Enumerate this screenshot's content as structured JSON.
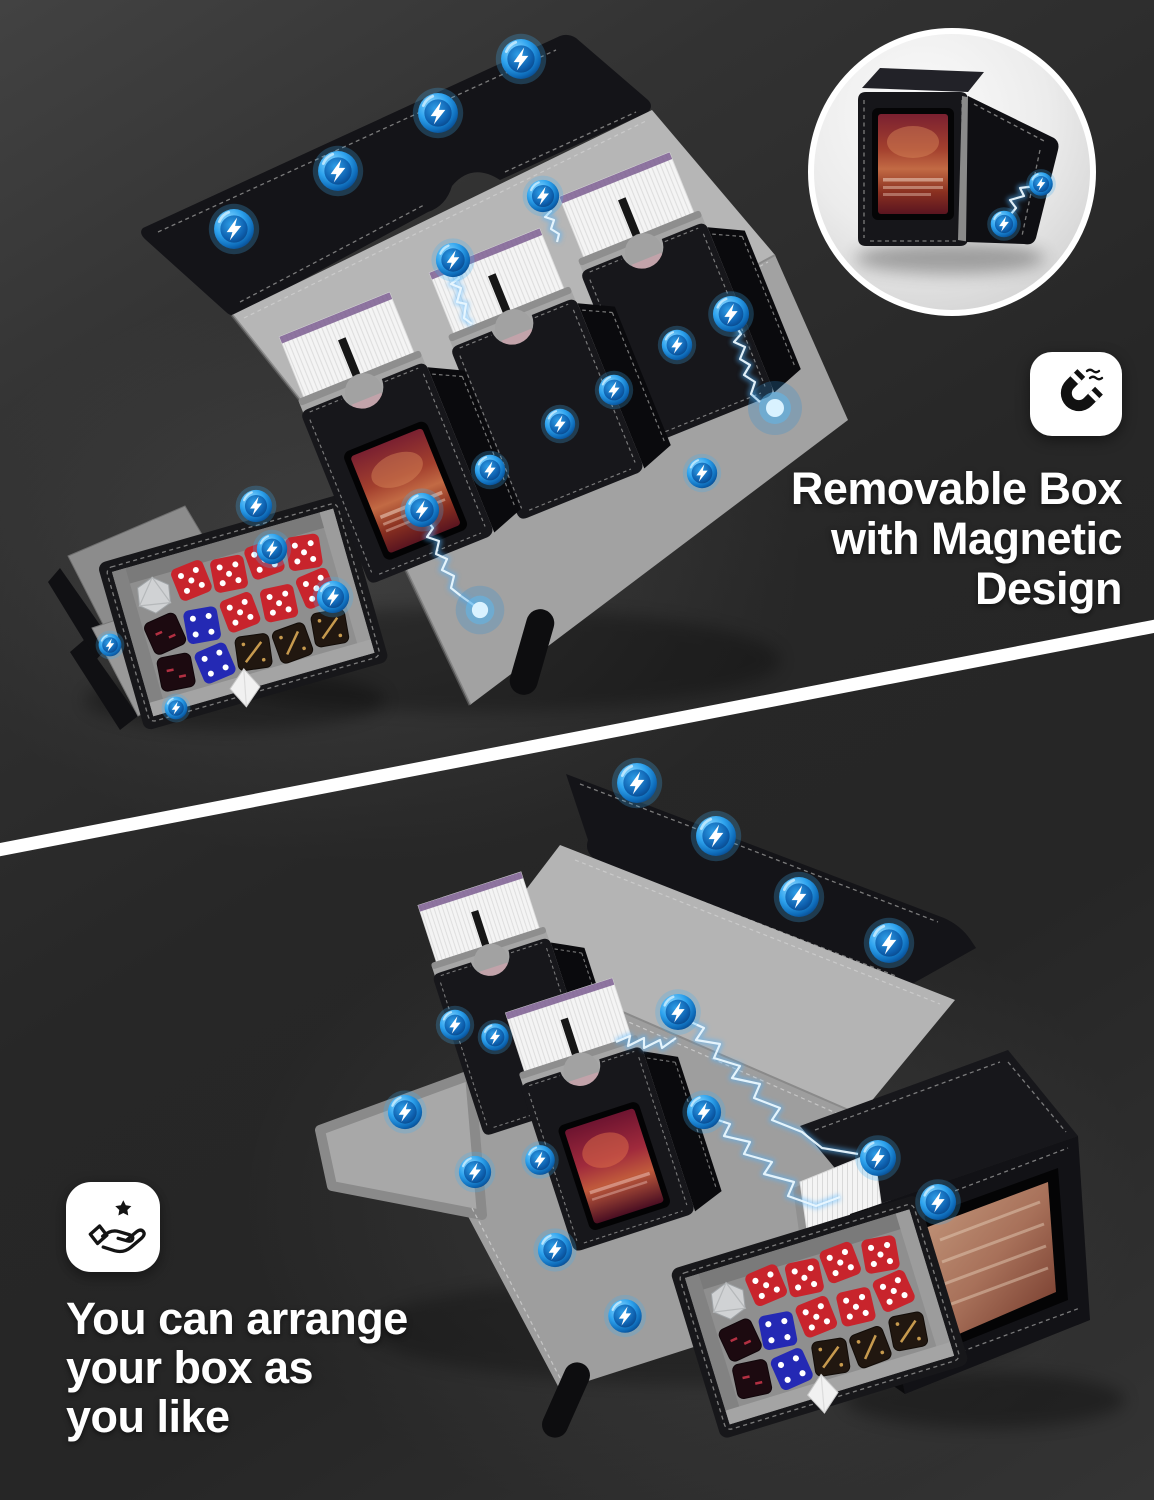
{
  "image": {
    "kind": "product-marketing-graphic",
    "background_color": "#2a2a2a",
    "divider_color": "#ffffff"
  },
  "palette": {
    "accent_blue": "#1e9be9",
    "leather_black": "#17171b",
    "interior_gray": "#a6a6a6",
    "card_white": "#f4f4f4",
    "sleeve_purple": "#7b5d90",
    "dice_red": "#c8242c",
    "dice_blue": "#2429b4",
    "dice_gold_mark": "#c79a4e",
    "text_white": "#ffffff"
  },
  "features": {
    "top": {
      "icon": "magnet-icon",
      "line1": "Removable Box",
      "line2": "with Magnetic",
      "line3": "Design"
    },
    "bottom": {
      "icon": "hand-star-icon",
      "line1": "You can arrange",
      "line2": "your box as",
      "line3": "you like"
    }
  }
}
